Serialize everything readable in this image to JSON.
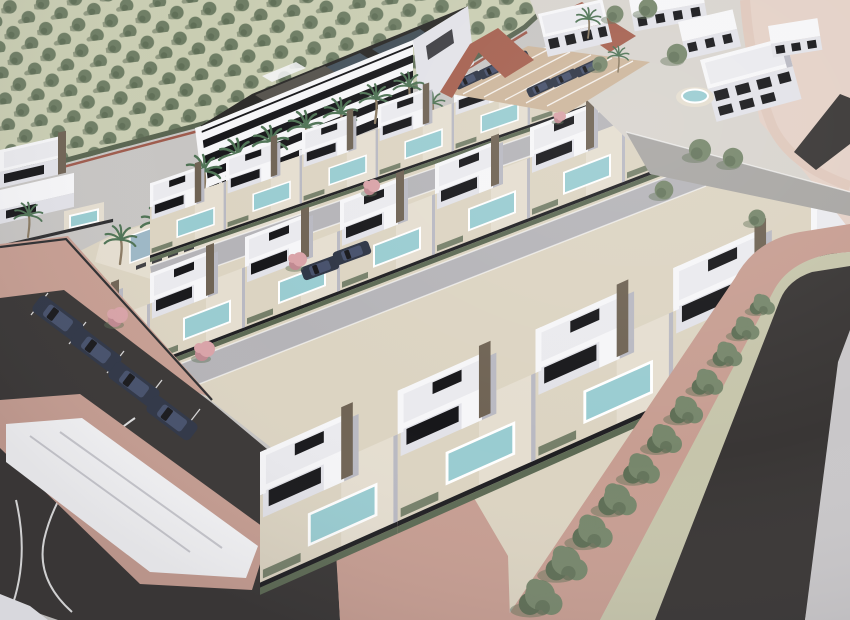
{
  "meta": {
    "title": "Aerial 3D architectural rendering of a residential development with white villas, private pools, an apartment block with communal lagoon pool, orchard fields, roads and tree-lined avenue",
    "type": "architectural-visualization",
    "text_content": "none"
  },
  "palette": {
    "base": "#c7c5c3",
    "orchardField": "#c9cdb2",
    "orchardTree": "#6e7d64",
    "orchardTreeDark": "#57664f",
    "hedgeLine": "#5a6551",
    "brickWall": "#9e5b4d",
    "travertine": "#dcd4c2",
    "deck": "#e5ded0",
    "white": "#f6f6f8",
    "whiteSoft": "#eaeaee",
    "face": "#e2e2e8",
    "faceShadow": "#b9b9c2",
    "win": "#17171a",
    "stone": "#6f6354",
    "wallCap": "#1f1f22",
    "hedge": "#5d6a54",
    "pool": "#99ccd1",
    "lagoon": "#9db7c6",
    "street": "#b5b4b8",
    "asphalt": "#393635",
    "sidewalkPink": "#c79e92",
    "pinkLand": "#e4d1c7",
    "landPath": "#dfc8bc",
    "median": "#c6c5ab",
    "rightWalk": "#c9c7c9",
    "parkingTan": "#cdb69c",
    "brickPath": "#a5604f",
    "clusterRoad": "#a8a6a3",
    "clusterGround": "#d8d4ce",
    "treeGreen": "#77876c",
    "treeDark": "#5e6e55",
    "palmGreen": "#4f7355",
    "trunk": "#8a7a62",
    "pinkTree": "#d9a3a8",
    "pinkTreeDark": "#c08890",
    "carNavy": "#2e3545",
    "carRoof": "#46506b",
    "carGray": "#555b66",
    "lounger": "#3f3f42",
    "roofDark": "#2b2a28",
    "panel": "#45525c",
    "penthouse": "#56534d"
  },
  "scene": {
    "villa_rows": [
      {
        "name": "row-a",
        "count": 8,
        "plots": [
          {
            "x": 0
          },
          {
            "x": 95
          },
          {
            "x": 190
          },
          {
            "x": 285
          },
          {
            "x": 380
          },
          {
            "x": 475
          },
          {
            "x": 570
          },
          {
            "x": 665
          }
        ]
      },
      {
        "name": "row-b",
        "count": 8,
        "plots": [
          {
            "x": 0
          },
          {
            "x": 95
          },
          {
            "x": 190
          },
          {
            "x": 285
          },
          {
            "x": 380
          },
          {
            "x": 475
          },
          {
            "x": 570
          },
          {
            "x": 665
          }
        ]
      },
      {
        "name": "row-c",
        "count": 5,
        "plots": [
          {
            "x": 0
          },
          {
            "x": 95
          },
          {
            "x": 190
          },
          {
            "x": 285
          },
          {
            "x": 380
          }
        ]
      }
    ],
    "apartment_palms": [
      {
        "x": 203,
        "y": 198,
        "s": 1.0
      },
      {
        "x": 237,
        "y": 184,
        "s": 1.05
      },
      {
        "x": 270,
        "y": 169,
        "s": 1.0
      },
      {
        "x": 305,
        "y": 154,
        "s": 1.0
      },
      {
        "x": 340,
        "y": 139,
        "s": 0.95
      },
      {
        "x": 375,
        "y": 123,
        "s": 0.9
      },
      {
        "x": 408,
        "y": 109,
        "s": 0.85
      }
    ],
    "amenity_palms": [
      {
        "x": 120,
        "y": 264,
        "s": 0.9
      },
      {
        "x": 158,
        "y": 250,
        "s": 1.0
      },
      {
        "x": 196,
        "y": 234,
        "s": 0.95
      },
      {
        "x": 235,
        "y": 218,
        "s": 1.0
      },
      {
        "x": 292,
        "y": 202,
        "s": 0.9
      },
      {
        "x": 330,
        "y": 187,
        "s": 0.85
      },
      {
        "x": 356,
        "y": 172,
        "s": 0.8
      },
      {
        "x": 28,
        "y": 237,
        "s": 0.8
      },
      {
        "x": 432,
        "y": 122,
        "s": 0.7
      }
    ],
    "avenue_trees": [
      {
        "x": 540,
        "y": 600,
        "s": 1.25
      },
      {
        "x": 566,
        "y": 566,
        "s": 1.2
      },
      {
        "x": 592,
        "y": 534,
        "s": 1.15
      },
      {
        "x": 617,
        "y": 502,
        "s": 1.1
      },
      {
        "x": 641,
        "y": 471,
        "s": 1.05
      },
      {
        "x": 664,
        "y": 441,
        "s": 1.0
      },
      {
        "x": 686,
        "y": 412,
        "s": 0.95
      },
      {
        "x": 707,
        "y": 384,
        "s": 0.9
      },
      {
        "x": 727,
        "y": 356,
        "s": 0.85
      },
      {
        "x": 745,
        "y": 330,
        "s": 0.8
      },
      {
        "x": 762,
        "y": 306,
        "s": 0.72
      }
    ],
    "cluster_trees": [
      {
        "x": 615,
        "y": 14,
        "s": 1.0
      },
      {
        "x": 648,
        "y": 8,
        "s": 1.1
      },
      {
        "x": 677,
        "y": 54,
        "s": 1.2
      },
      {
        "x": 700,
        "y": 150,
        "s": 1.3
      },
      {
        "x": 733,
        "y": 158,
        "s": 1.2
      },
      {
        "x": 664,
        "y": 190,
        "s": 1.1
      },
      {
        "x": 757,
        "y": 218,
        "s": 1.0
      },
      {
        "x": 600,
        "y": 64,
        "s": 0.9
      }
    ],
    "cluster_palms": [
      {
        "x": 588,
        "y": 38,
        "s": 0.7
      },
      {
        "x": 618,
        "y": 72,
        "s": 0.6
      }
    ],
    "pink_trees": [
      {
        "x": 118,
        "y": 318,
        "s": 1.0
      },
      {
        "x": 205,
        "y": 352,
        "s": 1.0
      },
      {
        "x": 298,
        "y": 262,
        "s": 0.9
      },
      {
        "x": 372,
        "y": 188,
        "s": 0.8
      },
      {
        "x": 560,
        "y": 118,
        "s": 0.6
      }
    ],
    "street_parked_cars": [
      {
        "x": 58,
        "y": 318,
        "r": 37,
        "s": 1.0
      },
      {
        "x": 96,
        "y": 350,
        "r": 37,
        "s": 1.0
      },
      {
        "x": 134,
        "y": 384,
        "r": 37,
        "s": 1.0
      },
      {
        "x": 172,
        "y": 418,
        "r": 37,
        "s": 1.0
      }
    ],
    "parking_lot_cars": [
      {
        "x": 468,
        "y": 80,
        "r": -25,
        "s": 0.5
      },
      {
        "x": 492,
        "y": 70,
        "r": -25,
        "s": 0.5
      },
      {
        "x": 516,
        "y": 60,
        "r": -25,
        "s": 0.5
      },
      {
        "x": 540,
        "y": 88,
        "r": -25,
        "s": 0.5
      },
      {
        "x": 564,
        "y": 78,
        "r": -25,
        "s": 0.5
      },
      {
        "x": 588,
        "y": 68,
        "r": -25,
        "s": 0.5
      }
    ],
    "interior_cars": [
      {
        "x": 320,
        "y": 268,
        "r": -20,
        "s": 0.7
      },
      {
        "x": 352,
        "y": 253,
        "r": -20,
        "s": 0.7
      }
    ],
    "loungers_row1": [
      {
        "x": 30
      },
      {
        "x": 46
      },
      {
        "x": 62
      },
      {
        "x": 78
      },
      {
        "x": 94
      },
      {
        "x": 110
      }
    ],
    "loungers_row2": [
      {
        "x": 6
      },
      {
        "x": 22
      },
      {
        "x": 38
      },
      {
        "x": 54
      }
    ]
  }
}
